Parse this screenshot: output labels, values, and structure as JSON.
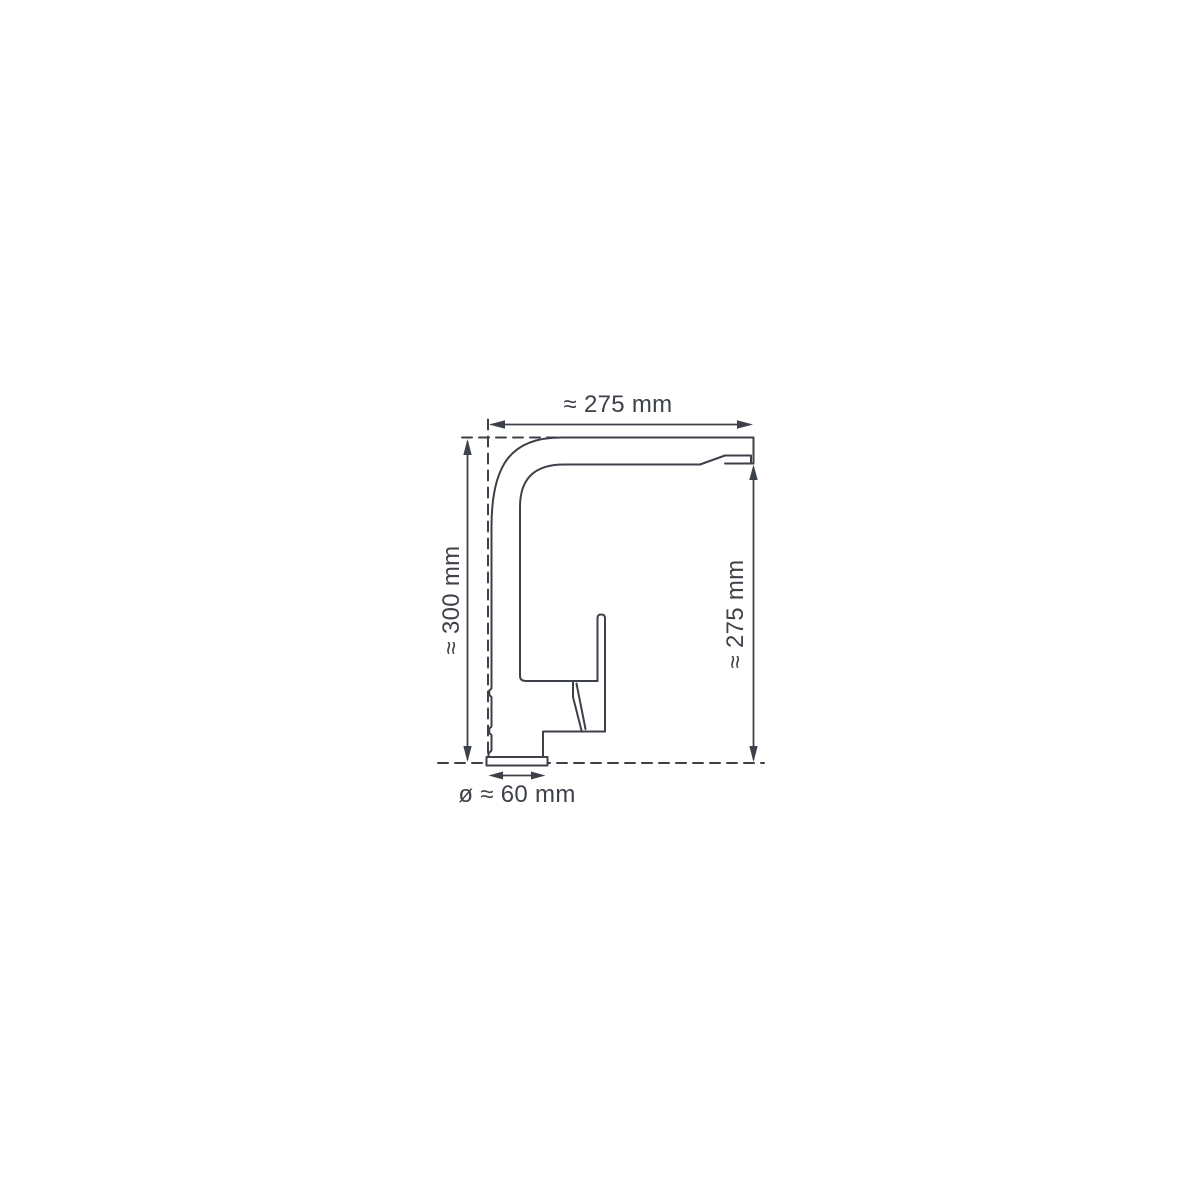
{
  "diagram": {
    "type": "technical-drawing",
    "subject": "kitchen-faucet-side-view-with-dimensions",
    "background_color": "#ffffff",
    "line_color": "#3d424a",
    "dimensions": {
      "top": "≈ 275 mm",
      "left": "≈ 300 mm",
      "right": "≈ 275 mm",
      "bottom": "ø ≈ 60 mm"
    }
  }
}
